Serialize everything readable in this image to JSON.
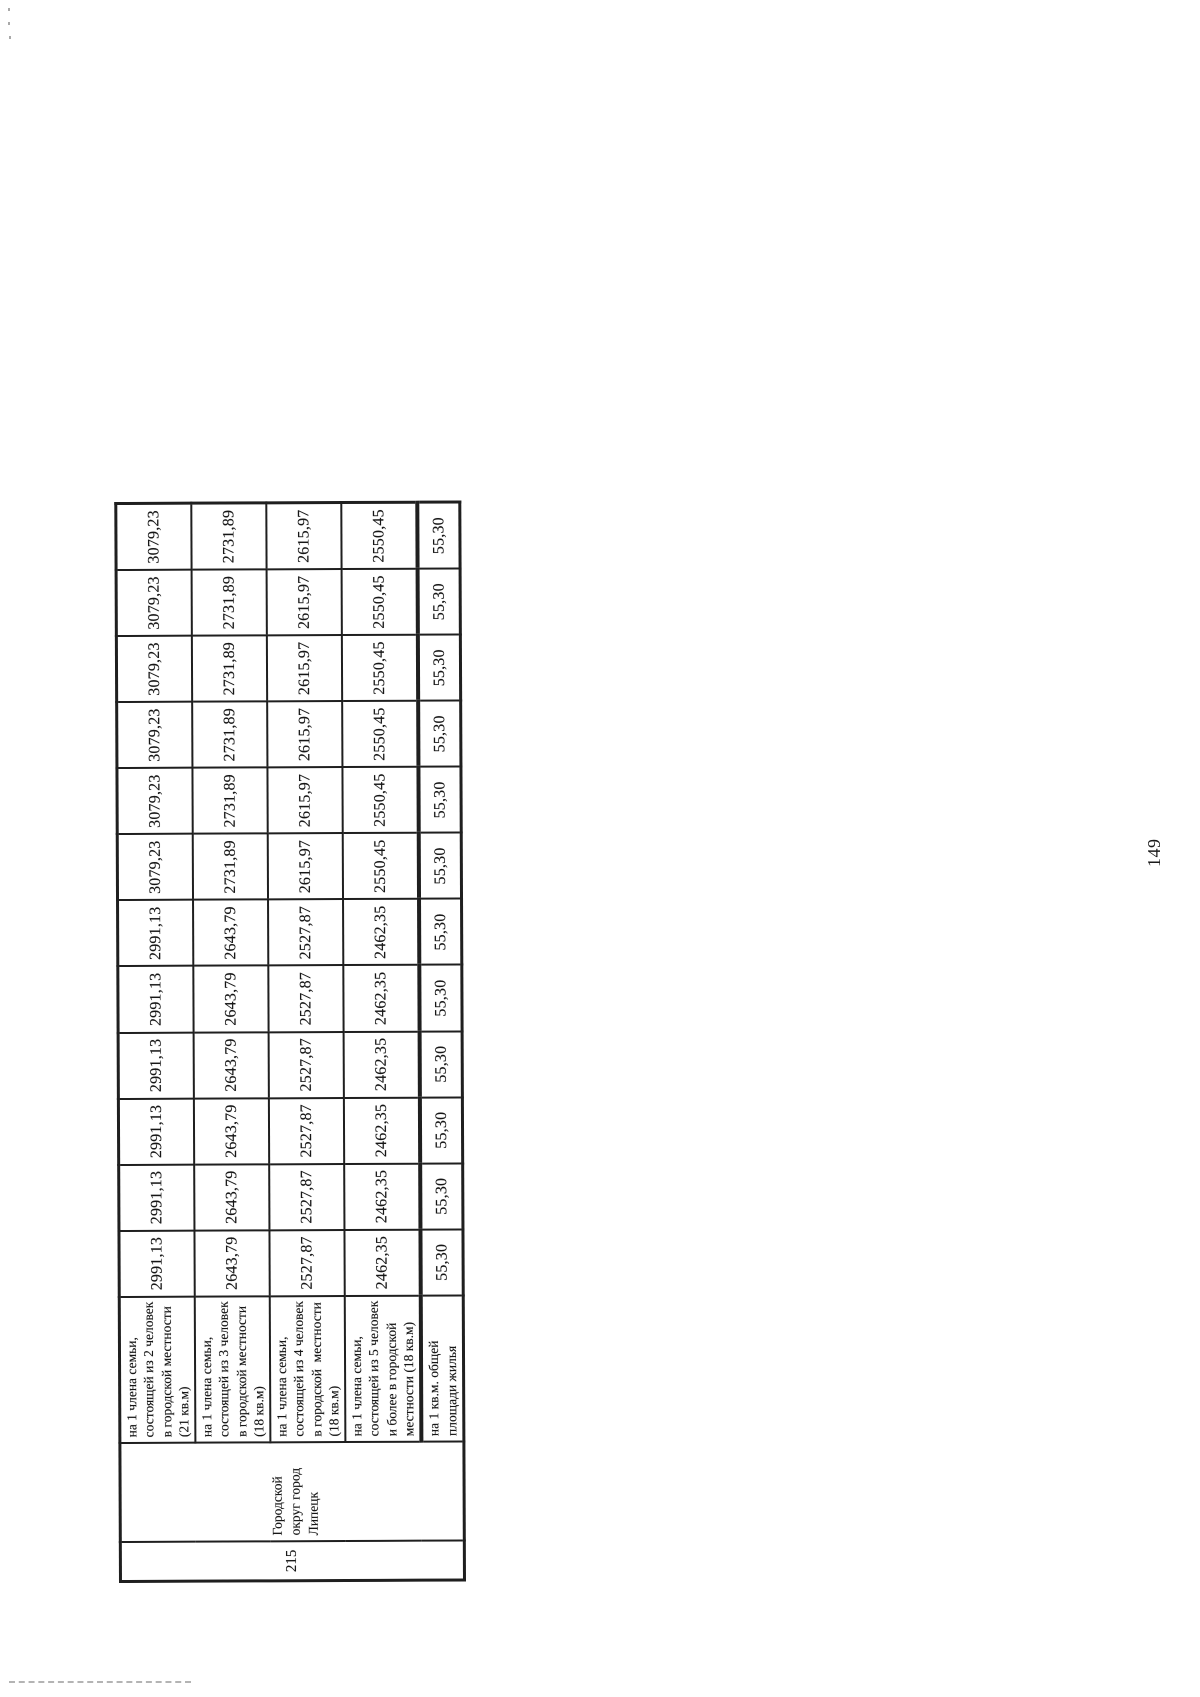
{
  "page": {
    "number": "149"
  },
  "table": {
    "row_id": "215",
    "territory": "Городской округ город Липецк",
    "rows": [
      {
        "label": "на 1 члена семьи, состоящей из 2 человек в городской местности  (21 кв.м)",
        "values": [
          "2991,13",
          "2991,13",
          "2991,13",
          "2991,13",
          "2991,13",
          "2991,13",
          "3079,23",
          "3079,23",
          "3079,23",
          "3079,23",
          "3079,23",
          "3079,23"
        ]
      },
      {
        "label": "на 1 члена семьи, состоящей из 3 человек в городской местности (18 кв.м)",
        "values": [
          "2643,79",
          "2643,79",
          "2643,79",
          "2643,79",
          "2643,79",
          "2643,79",
          "2731,89",
          "2731,89",
          "2731,89",
          "2731,89",
          "2731,89",
          "2731,89"
        ]
      },
      {
        "label": "на 1 члена семьи, состоящей из 4 человек в городской  местности  (18 кв.м)",
        "values": [
          "2527,87",
          "2527,87",
          "2527,87",
          "2527,87",
          "2527,87",
          "2527,87",
          "2615,97",
          "2615,97",
          "2615,97",
          "2615,97",
          "2615,97",
          "2615,97"
        ]
      },
      {
        "label": "на 1 члена семьи, состоящей из 5 человек и более в городской местности (18 кв.м)",
        "values": [
          "2462,35",
          "2462,35",
          "2462,35",
          "2462,35",
          "2462,35",
          "2462,35",
          "2550,45",
          "2550,45",
          "2550,45",
          "2550,45",
          "2550,45",
          "2550,45"
        ]
      },
      {
        "label": "на 1 кв.м. общей площади жилья",
        "values": [
          "55,30",
          "55,30",
          "55,30",
          "55,30",
          "55,30",
          "55,30",
          "55,30",
          "55,30",
          "55,30",
          "55,30",
          "55,30",
          "55,30"
        ]
      }
    ]
  }
}
